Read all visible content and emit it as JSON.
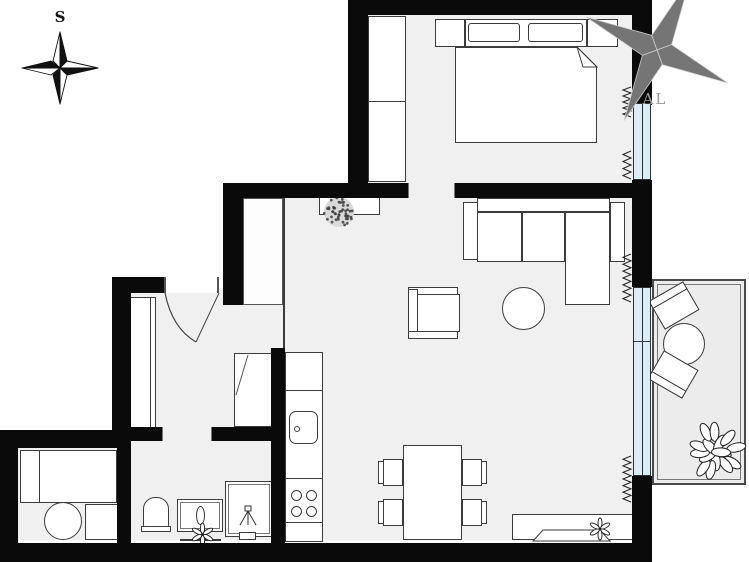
{
  "document": {
    "kind": "floor-plan-drawing"
  },
  "compass": {
    "label": "S"
  },
  "watermark": {
    "text": "AL"
  },
  "colors": {
    "background": "#ffffff",
    "wall": "#0a0a0a",
    "floor": "#f0f0f0",
    "balcony_floor": "#ececec",
    "window_glass": "#dbeef6",
    "outline": "#3c3c3c",
    "watermark": "#757575"
  },
  "symbols": [
    "compass-rose",
    "exterior-wall",
    "interior-wall",
    "window",
    "radiator",
    "door-swing",
    "double-bed",
    "pillow",
    "nightstand",
    "wardrobe",
    "shelf-with-plant",
    "sectional-sofa",
    "coffee-table",
    "armchair",
    "dining-table",
    "dining-chair",
    "tv-sideboard",
    "kitchen-counter",
    "kitchen-sink",
    "cooktop",
    "bathroom-vanity",
    "toilet",
    "shower",
    "washing-machine",
    "storage-cabinet",
    "balcony",
    "balcony-table",
    "balcony-chair",
    "potted-plant"
  ]
}
